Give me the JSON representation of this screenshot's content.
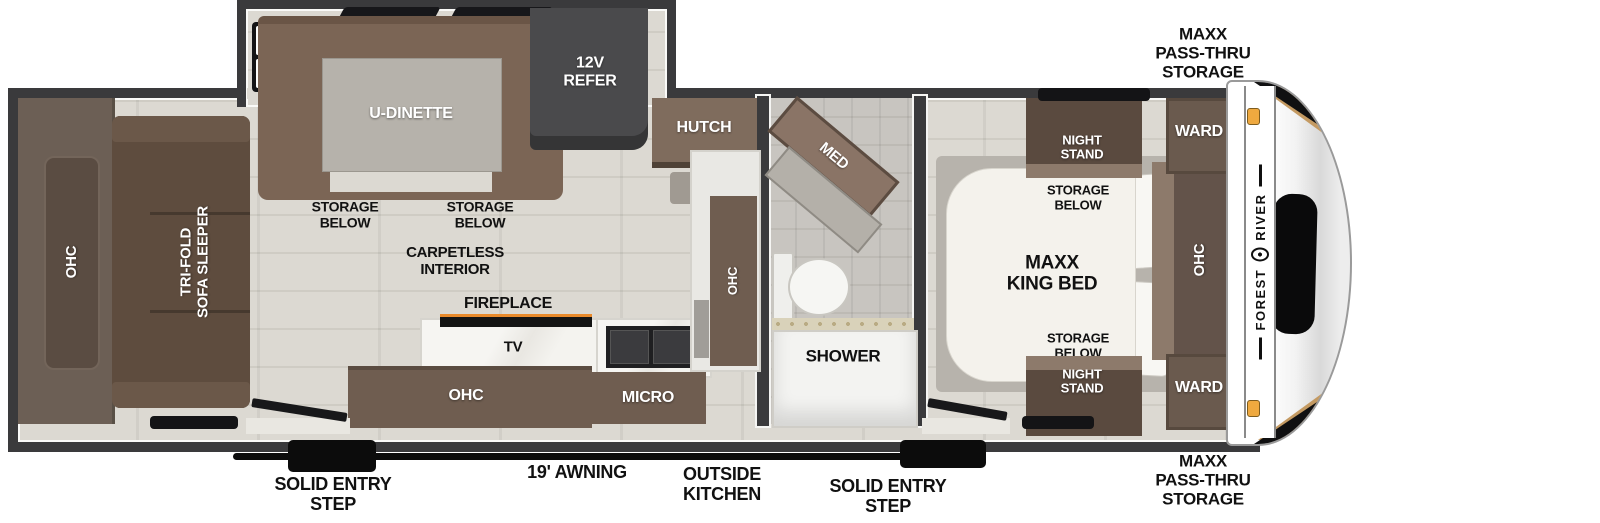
{
  "colors": {
    "wall": "#3a3a3c",
    "floor": "#dcd9d2",
    "floor_seam": "#cfccc4",
    "bath_floor": "#c8c5c0",
    "cabinet": "#6f5d50",
    "cabinet_dark": "#57493e",
    "cabinet_light": "#8d7a6b",
    "sofa": "#5e4c3e",
    "dinette": "#7b6555",
    "table_gray": "#b6b2ab",
    "refer": "#4a4a4c",
    "counter": "#eceae6",
    "bed": "#f4f2ec",
    "platform": "#b7b3ac",
    "black": "#0c0c0c",
    "label": "#111111",
    "accent_light": "#efa93f",
    "gold": "#c49a62"
  },
  "exterior": {
    "storage_label_top": "MAXX\nPASS-THRU\nSTORAGE",
    "storage_label_bottom": "MAXX\nPASS-THRU\nSTORAGE",
    "awning_label": "19' AWNING",
    "outside_kitchen_label": "OUTSIDE\nKITCHEN",
    "entry_step_label_left": "SOLID ENTRY\nSTEP",
    "entry_step_label_right": "SOLID ENTRY\nSTEP",
    "brand_word_1": "FOREST",
    "brand_word_2": "RIVER"
  },
  "living_area": {
    "rear_ohc": "OHC",
    "sofa": "TRI-FOLD\nSOFA SLEEPER",
    "dinette": "U-DINETTE",
    "storage_below_left": "STORAGE\nBELOW",
    "storage_below_right": "STORAGE\nBELOW",
    "refrigerator": "12V\nREFER",
    "hutch": "HUTCH",
    "flooring_note": "CARPETLESS\nINTERIOR",
    "fireplace": "FIREPLACE",
    "tv": "TV",
    "kitchen_ohc": "OHC",
    "microwave": "MICRO",
    "kitchen_side_ohc": "OHC"
  },
  "bathroom": {
    "medicine_cabinet": "MED",
    "shower": "SHOWER"
  },
  "bedroom": {
    "night_stand_top": "NIGHT\nSTAND",
    "storage_below_top": "STORAGE\nBELOW",
    "bed": "MAXX\nKING BED",
    "storage_below_bottom": "STORAGE\nBELOW",
    "night_stand_bottom": "NIGHT\nSTAND",
    "wardrobe_top": "WARD",
    "wardrobe_bottom": "WARD",
    "front_ohc": "OHC"
  }
}
